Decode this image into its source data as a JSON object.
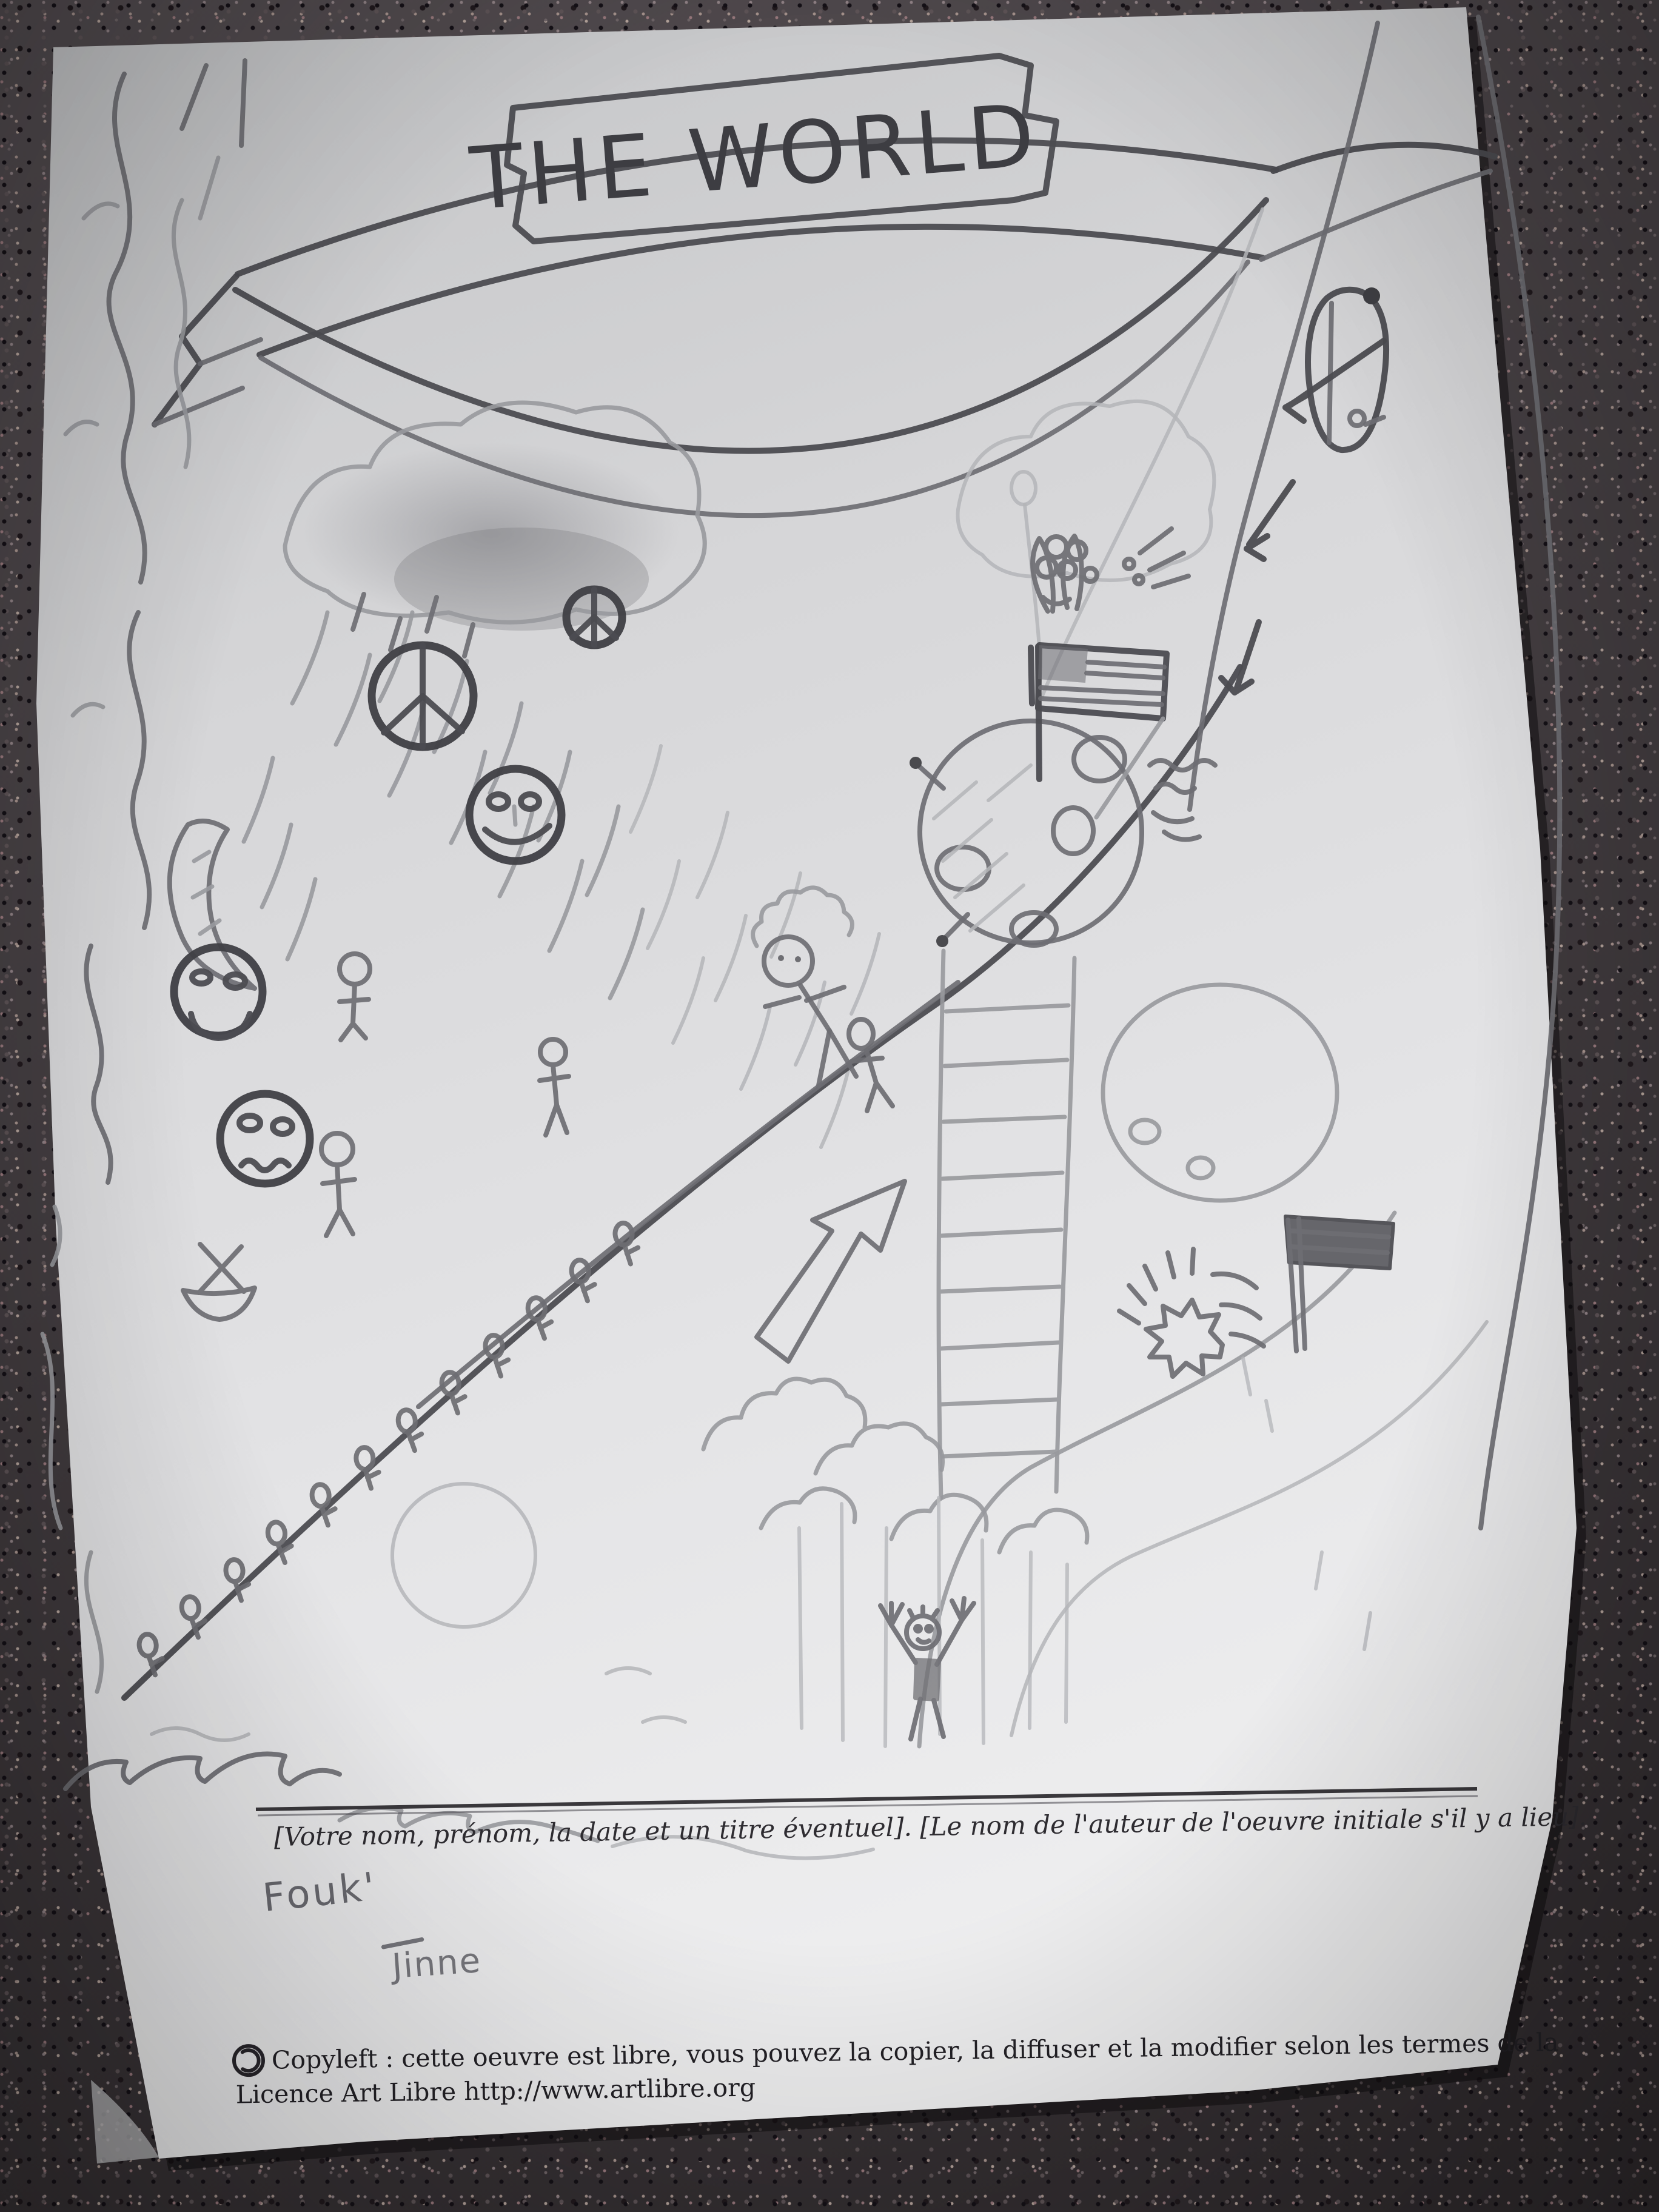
{
  "banner": {
    "title": "THE WORLD"
  },
  "footer": {
    "attribution_placeholder": "[Votre nom, prénom, la date et un titre éventuel]. [Le nom de l'auteur de l'oeuvre initiale s'il y a lieu].",
    "signature_line1": "Fouk'",
    "signature_line2": "Jinne",
    "license_line1": "Copyleft : cette oeuvre est libre, vous pouvez la copier, la diffuser et la modifier selon les termes de la",
    "license_line2": "Licence Art Libre http://www.artlibre.org",
    "copyleft_symbol_name": "copyleft-icon"
  },
  "colors": {
    "granite_base": "#453e42",
    "paper_light": "#e9e9ea",
    "paper_dark": "#c6c7c9",
    "pencil_dark": "#3f3f44",
    "pencil_medium": "#6e6e73",
    "pencil_light": "#98999d",
    "printed_ink": "#232126"
  },
  "drawing_elements": [
    "banner-ribbon",
    "rainbow-arcs",
    "storm-cloud",
    "rain-streaks",
    "peace-sign-small",
    "peace-sign-large",
    "crescent-moon-icon",
    "smiley-face-icon",
    "sad-face-icon",
    "worried-face-icon",
    "stick-figures",
    "sprout-figure-line",
    "curly-hair-climber",
    "boat-icon",
    "waves-water",
    "coastline-squiggles",
    "up-arrow-outline",
    "ladder-icon",
    "moon-with-craters",
    "usa-flag-icon",
    "victory-hand-icon",
    "satellite-antennae",
    "wind-squiggles",
    "car-icon",
    "down-arrow-icons",
    "road-lines",
    "planet-circle",
    "dark-flag-icon",
    "starburst-explosion",
    "trees-forest",
    "cheering-person",
    "sun-circle",
    "copyleft-icon"
  ]
}
